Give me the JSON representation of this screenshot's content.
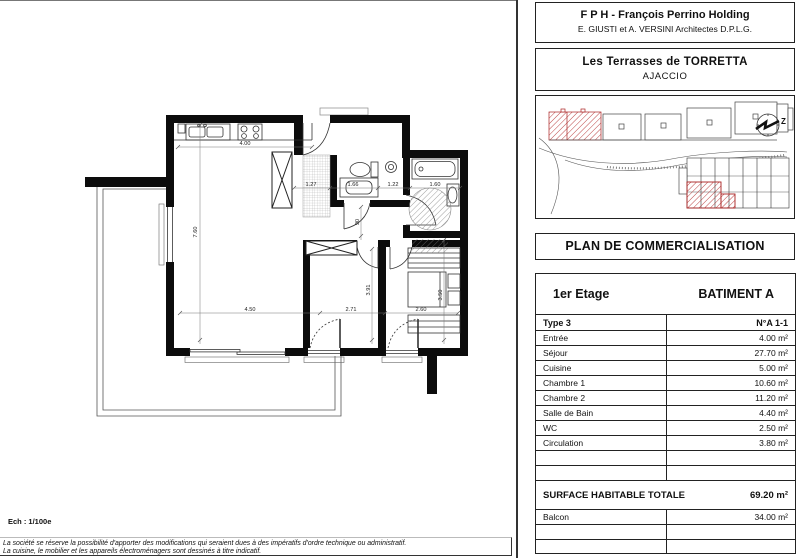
{
  "firm": {
    "name": "F P H - François Perrino Holding",
    "architects": "E. GIUSTI et A. VERSINI Architectes D.P.L.G."
  },
  "project": {
    "name": "Les Terrasses de TORRETTA",
    "city": "AJACCIO"
  },
  "plan_title": "PLAN DE COMMERCIALISATION",
  "unit": {
    "floor": "1er Etage",
    "building": "BATIMENT A",
    "type": "Type 3",
    "number": "N°A 1-1",
    "rooms": [
      {
        "label": "Entrée",
        "area": "4.00 m²"
      },
      {
        "label": "Séjour",
        "area": "27.70 m²"
      },
      {
        "label": "Cuisine",
        "area": "5.00 m²"
      },
      {
        "label": "Chambre 1",
        "area": "10.60 m²"
      },
      {
        "label": "Chambre 2",
        "area": "11.20 m²"
      },
      {
        "label": "Salle de Bain",
        "area": "4.40 m²"
      },
      {
        "label": "WC",
        "area": "2.50 m²"
      },
      {
        "label": "Circulation",
        "area": "3.80 m²"
      }
    ],
    "total_label": "SURFACE HABITABLE TOTALE",
    "total_area": "69.20 m²",
    "balcony_label": "Balcon",
    "balcony_area": "34.00 m²"
  },
  "scale_label": "Ech : 1/100e",
  "disclaimer": {
    "line1": "La société se réserve la possibilité d'apporter des modifications qui seraient dues à des impératifs d'ordre technique ou administratif.",
    "line2": "La cuisine, le mobilier et les appareils électroménagers sont dessinés à titre indicatif."
  },
  "floorplan": {
    "dims": {
      "kitchen_w": "4.00",
      "entry_w": "1.27",
      "wc_w": "1.66",
      "hall_w": "1.22",
      "bath_w": "1.60",
      "sejour_h": "7.60",
      "circulation_h": "90",
      "sejour_w": "4.50",
      "chambre1_w": "2.71",
      "chambre1_h": "3.91",
      "chambre2_w": "2.60",
      "chambre2_h": "3.50"
    },
    "compass_letter": "Z"
  },
  "colors": {
    "wall": "#0c0c0c",
    "red_hatch": "#b53131",
    "dim_line": "#666666"
  }
}
